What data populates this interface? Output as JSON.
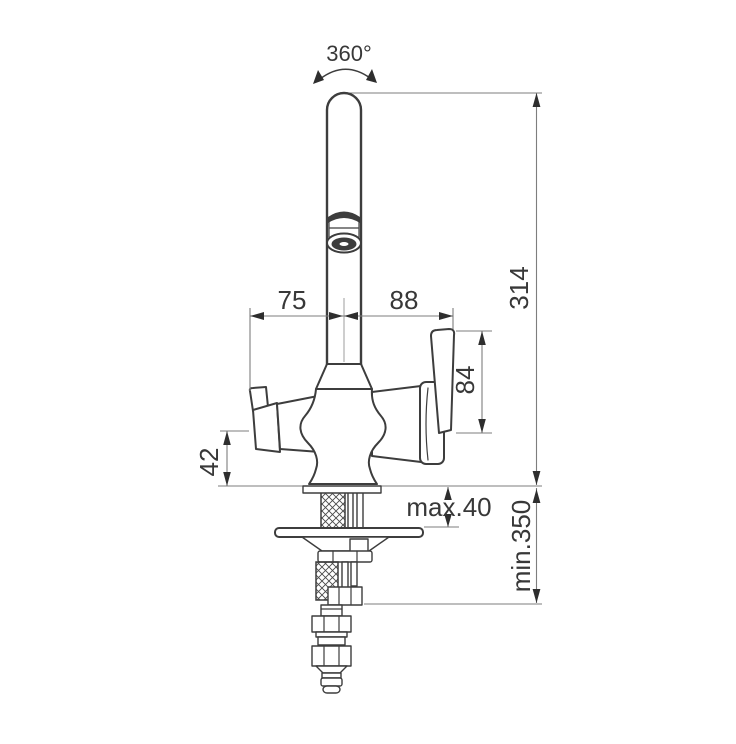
{
  "drawing": {
    "colors": {
      "outline": "#3d3d3d",
      "dim": "#7e7e7e",
      "arrow": "#2e2e2e",
      "text": "#383838",
      "background": "#ffffff"
    },
    "labels": {
      "swivel_angle": "360°",
      "offset_left": "75",
      "offset_right": "88",
      "overall_height": "314",
      "handle_length": "84",
      "handle_clearance": "42",
      "deck_thickness": "max.40",
      "hose_min_length": "min.350"
    }
  }
}
